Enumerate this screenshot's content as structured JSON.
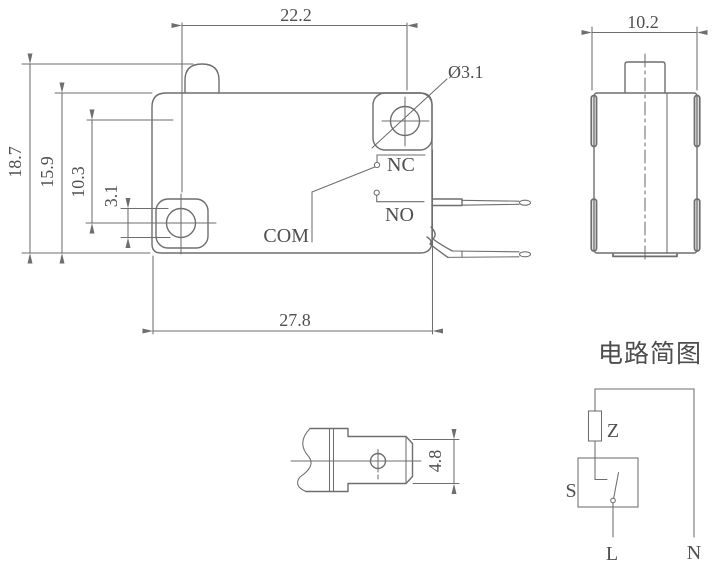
{
  "front_view": {
    "dim_hole_spacing_h": "22.2",
    "dim_total_height": "18.7",
    "dim_body_height": "15.9",
    "dim_hole_spacing_v": "10.3",
    "dim_hole_diameter_side": "3.1",
    "dim_body_width": "27.8",
    "hole_diameter_label": "Ø3.1",
    "label_nc": "NC",
    "label_no": "NO",
    "label_com": "COM"
  },
  "side_view": {
    "dim_width": "10.2"
  },
  "terminal_view": {
    "dim_blade_width": "4.8"
  },
  "circuit_diagram": {
    "title": "电路简图",
    "label_load": "Z",
    "label_switch": "S",
    "label_live": "L",
    "label_neutral": "N"
  },
  "colors": {
    "line_stroke": "#6e6e6e",
    "text": "#4f4f4f",
    "background": "#ffffff"
  }
}
